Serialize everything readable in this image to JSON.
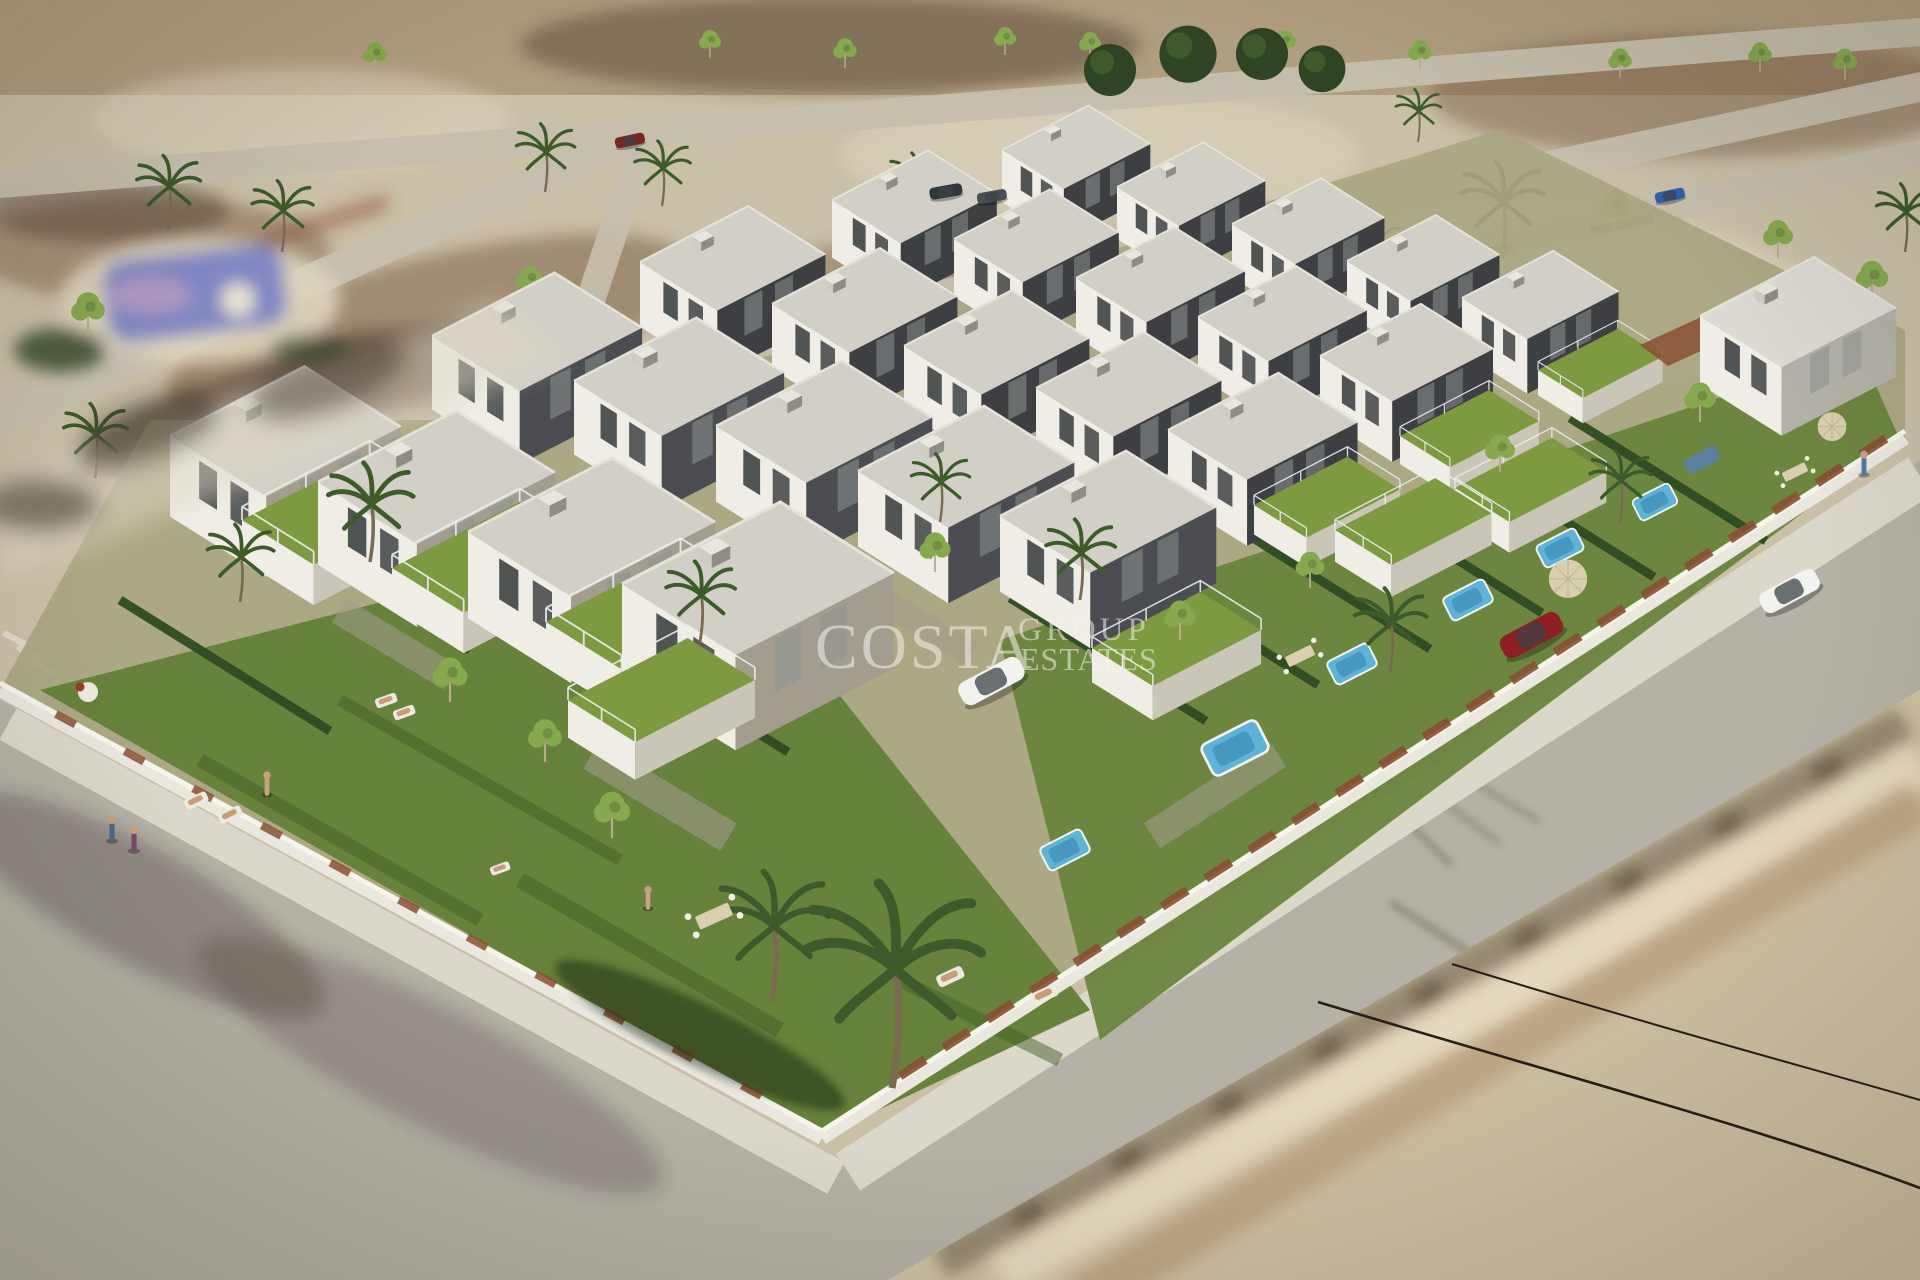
{
  "watermark": {
    "brand": "COSTA",
    "line2": "GROUP",
    "line3": "ESTATES"
  },
  "colors": {
    "sand": "#cabfa7",
    "sandTop": "#b09d7f",
    "sandLight": "#ddd4bd",
    "soil": "#7d6048",
    "soilDark": "#4e3a2c",
    "roadBg": "#c6bfae",
    "road": "#b5b1a6",
    "roadLight": "#c6c2b6",
    "sidewalk": "#dbd7ca",
    "wall": "#e9e7de",
    "wallHi": "#f6f4ec",
    "grass": "#67823a",
    "grassDark": "#46602a",
    "hedge": "#2f4a22",
    "terrace": "#7d9a40",
    "roof": "#d2cfc6",
    "roofLight": "#e5e2d9",
    "facadeWhite": "#efede5",
    "facadeShade": "#c9c5b8",
    "facadeDark": "#3d3f43",
    "stone": "#a39d8f",
    "pool": "#5fb4d6",
    "poolDeep": "#3f8fb5",
    "communityPool": "#8087c2",
    "corten": "#8a4f33",
    "palm": "#3d5a2b",
    "treeGreen": "#86a84e",
    "treeDark": "#2e4424",
    "carWhite": "#f2f2ee",
    "carRed": "#8e1f24",
    "carBlue": "#2f5fae",
    "carDark": "#33363a",
    "parasol": "#d9cfae",
    "shadow": "#3a332a",
    "cable": "#241f19",
    "blurBuilding": "#cfc2a4",
    "watermark": "#f5f3ee"
  }
}
